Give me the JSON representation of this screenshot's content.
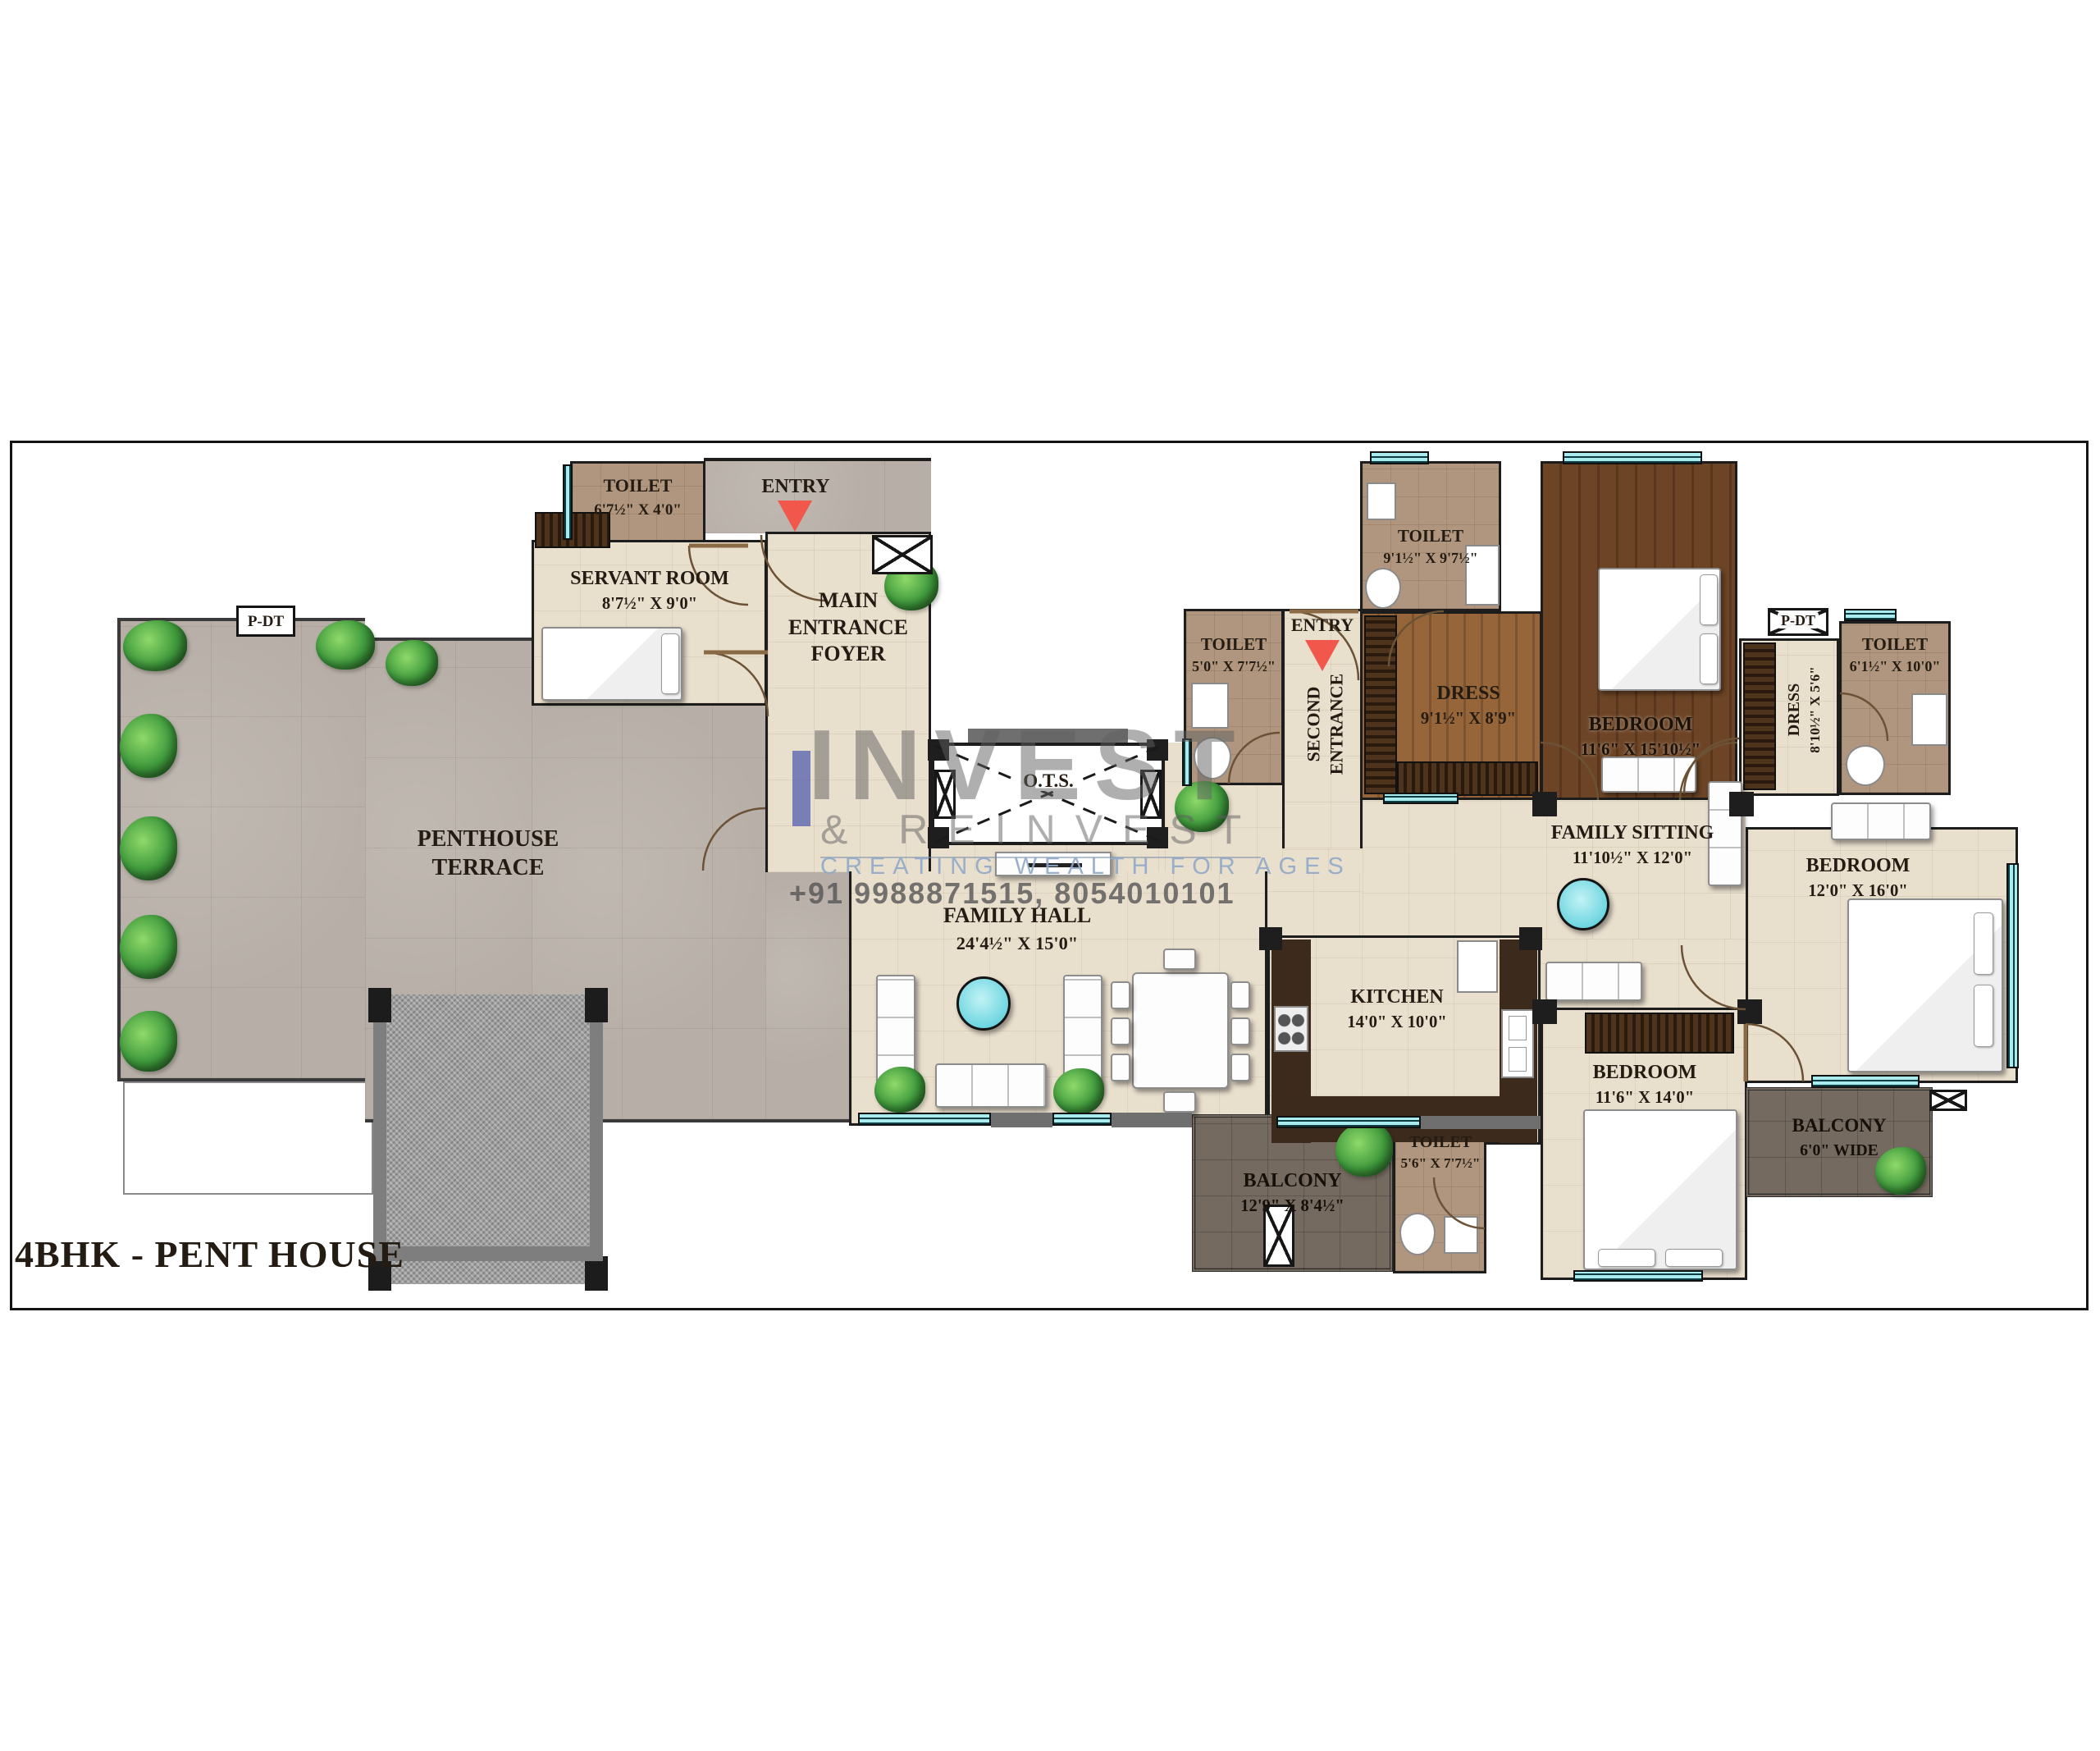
{
  "title": "4BHK - PENT HOUSE",
  "watermark": {
    "brand_top": "INVEST",
    "brand_bottom": "& REINVEST",
    "tagline": "CREATING WEALTH FOR AGES",
    "phone": "+91 9988871515, 8054010101"
  },
  "markers": {
    "entry": "ENTRY",
    "second_entrance_line1": "SECOND",
    "second_entrance_line2": "ENTRANCE",
    "pdt": "P-DT",
    "ots": "O.T.S."
  },
  "rooms": {
    "terrace": {
      "name": "PENTHOUSE TERRACE",
      "dims": ""
    },
    "servant_toilet": {
      "name": "TOILET",
      "dims": "6'7½\" X 4'0\""
    },
    "servant_room": {
      "name": "SERVANT ROOM",
      "dims": "8'7½\" X 9'0\""
    },
    "foyer": {
      "name": "MAIN ENTRANCE FOYER",
      "dims": ""
    },
    "toilet_50": {
      "name": "TOILET",
      "dims": "5'0\" X 7'7½\""
    },
    "toilet_91": {
      "name": "TOILET",
      "dims": "9'1½\" X 9'7½\""
    },
    "dress_91": {
      "name": "DRESS",
      "dims": "9'1½\" X 8'9\""
    },
    "bedroom_master": {
      "name": "BEDROOM",
      "dims": "11'6\" X 15'10½\""
    },
    "dress_810": {
      "name": "DRESS",
      "dims": "8'10½\" X 5'6\""
    },
    "toilet_61": {
      "name": "TOILET",
      "dims": "6'1½\" X 10'0\""
    },
    "family_sitting": {
      "name": "FAMILY SITTING",
      "dims": "11'10½\" X 12'0\""
    },
    "bedroom_12x16": {
      "name": "BEDROOM",
      "dims": "12'0\" X 16'0\""
    },
    "family_hall": {
      "name": "FAMILY HALL",
      "dims": "24'4½\" X 15'0\""
    },
    "kitchen": {
      "name": "KITCHEN",
      "dims": "14'0\" X 10'0\""
    },
    "bedroom_11x14": {
      "name": "BEDROOM",
      "dims": "11'6\" X 14'0\""
    },
    "toilet_56": {
      "name": "TOILET",
      "dims": "5'6\" X 7'7½\""
    },
    "balcony_129": {
      "name": "BALCONY",
      "dims": "12'9\" X 8'4½\""
    },
    "balcony_60": {
      "name": "BALCONY",
      "dims": "6'0\" WIDE"
    }
  },
  "colors": {
    "entry_arrow": "#f2574b",
    "window_glass": "#a9ecef",
    "watermark_blue": "#5b66b0",
    "tagline_blue": "#8fa8c8"
  }
}
